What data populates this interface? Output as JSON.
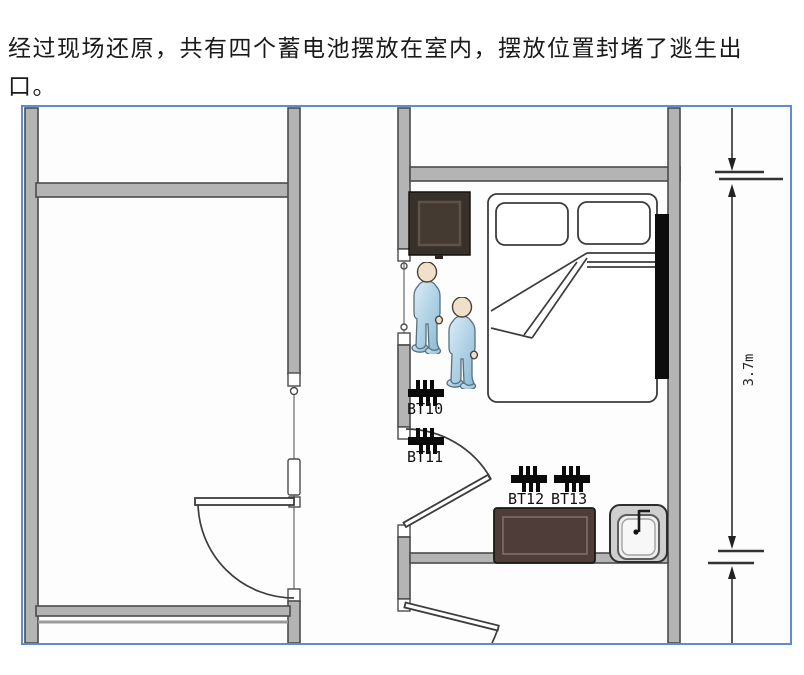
{
  "caption": {
    "lines": [
      "经过现场还原，共有四个蓄电池摆放在室内，摆放位置封堵了逃生出",
      "口。"
    ]
  },
  "floor_plan": {
    "battery_labels": [
      "BT10",
      "BT11",
      "BT12",
      "BT13"
    ],
    "dimension_label": "3.7m",
    "colors": {
      "figure_border_blue": "#5b8dd0",
      "wall_fill": "#b4b4b4",
      "wall_edge": "#4b4b4b",
      "battery_black": "#0a0a0a",
      "cabinet_dark_brown": "#38302a",
      "sofa_dark_brown": "#4e3d39",
      "blocker_bar_black": "#0c0c0c",
      "sink_gray": "#cfcfcf",
      "person_blue": "#aed0e4",
      "person_head_tan": "#efe1c9"
    }
  }
}
